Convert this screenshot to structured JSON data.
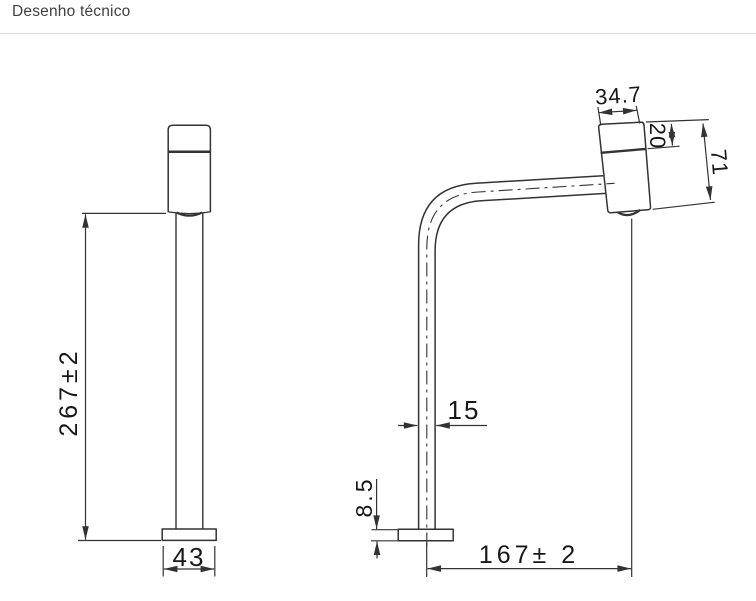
{
  "page": {
    "title": "Desenho técnico"
  },
  "drawing": {
    "colors": {
      "line": "#333333",
      "text": "#181818",
      "divider": "#dcdcdc",
      "background": "#ffffff"
    },
    "front_view": {
      "label": "front view",
      "dims": {
        "height": "267±2",
        "base_width": "43"
      }
    },
    "side_view": {
      "label": "side view",
      "dims": {
        "head_width": "34.7",
        "cap_height": "20",
        "head_height": "71",
        "tube_width": "15",
        "base_thickness": "8.5",
        "reach": "167± 2"
      }
    }
  }
}
